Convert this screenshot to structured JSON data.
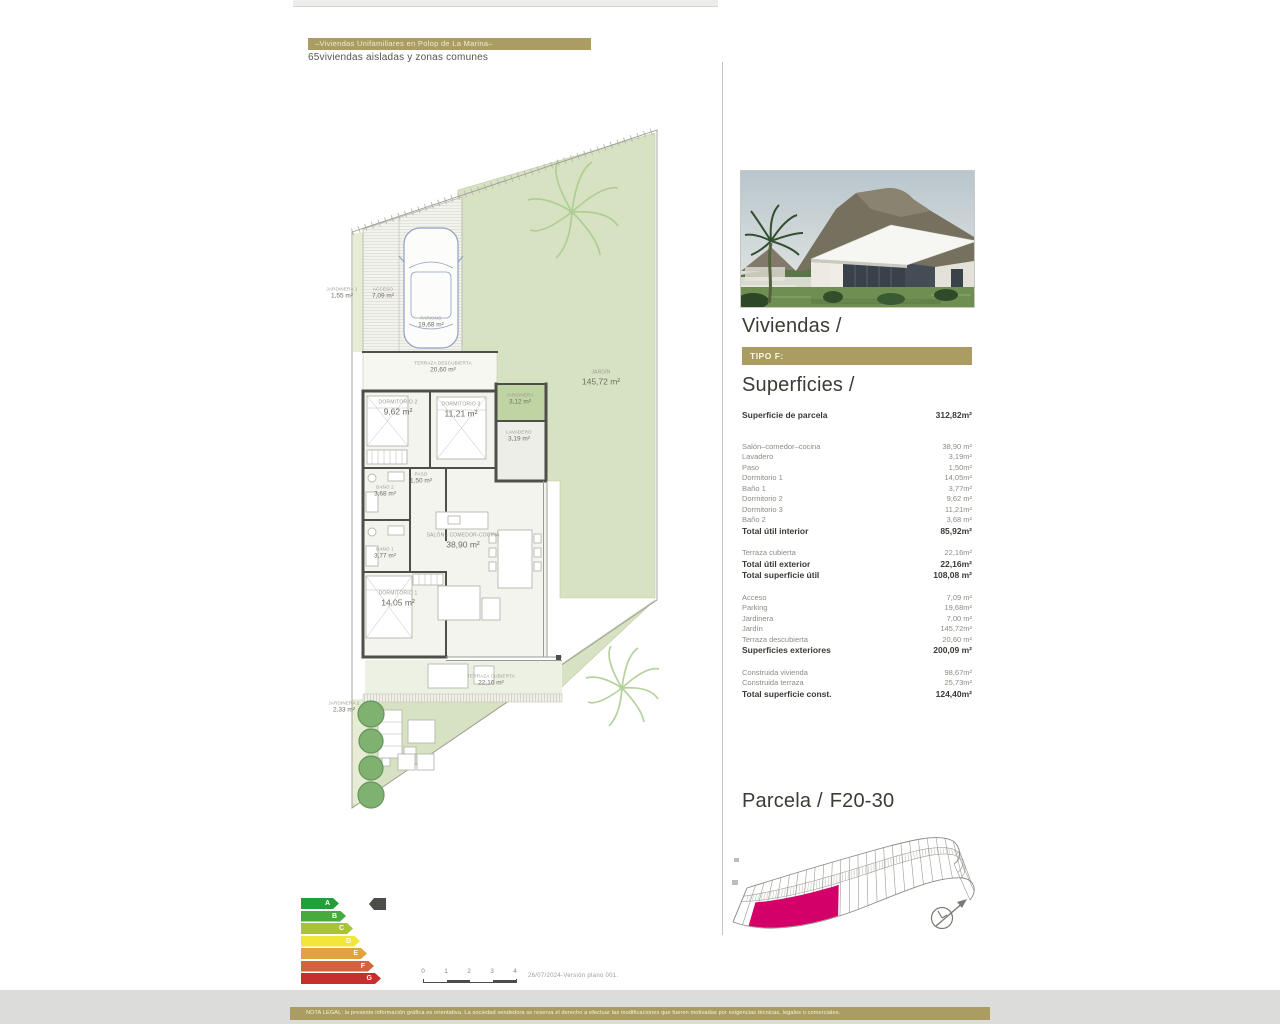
{
  "header": {
    "title": "–Viviendas Unifamiliares en Polop de La Marina–",
    "subtitle": "65viviendas aisladas y zonas comunes"
  },
  "right_panel": {
    "viviendas_title": "Viviendas /",
    "tipo_label": "TIPO F:",
    "superficies_title": "Superficies /",
    "parcela_title": "Parcela /",
    "parcela_code": "F20-30"
  },
  "superficies": {
    "sections": [
      {
        "rows": [
          {
            "label": "Superficie de parcela",
            "value": "312,82m²",
            "bold": true
          }
        ]
      },
      {
        "rows": [
          {
            "label": "Salón–comedor–cocina",
            "value": "38,90 m²"
          },
          {
            "label": "Lavadero",
            "value": "3,19m²"
          },
          {
            "label": "Paso",
            "value": "1,50m²"
          },
          {
            "label": "Dormitorio 1",
            "value": "14,05m²"
          },
          {
            "label": "Baño 1",
            "value": "3,77m²"
          },
          {
            "label": "Dormitorio 2",
            "value": "9,62 m²"
          },
          {
            "label": "Dormitorio 3",
            "value": "11,21m²"
          },
          {
            "label": "Baño 2",
            "value": "3,68 m²"
          },
          {
            "label": "Total útil  interior",
            "value": "85,92m²",
            "bold": true
          }
        ]
      },
      {
        "rows": [
          {
            "label": "Terraza cubierta",
            "value": "22,16m²"
          },
          {
            "label": "Total útil  exterior",
            "value": "22,16m²",
            "bold": true
          },
          {
            "label": "Total superficie útil",
            "value": "108,08 m²",
            "bold": true
          }
        ]
      },
      {
        "rows": [
          {
            "label": "Acceso",
            "value": "7,09 m²"
          },
          {
            "label": "Parking",
            "value": "19,68m²"
          },
          {
            "label": "Jardinera",
            "value": "7,00 m²"
          },
          {
            "label": "Jardín",
            "value": "145,72m²"
          },
          {
            "label": "Terraza descubierta",
            "value": "20,60 m²"
          },
          {
            "label": "Superficies exteriores",
            "value": "200,09 m²",
            "bold": true
          }
        ]
      },
      {
        "rows": [
          {
            "label": "Construida vivienda",
            "value": "98,67m²"
          },
          {
            "label": "Construida terraza",
            "value": "25,73m²"
          },
          {
            "label": "Total superficie const.",
            "value": "124,40m²",
            "bold": true
          }
        ]
      }
    ]
  },
  "floorplan": {
    "labels": [
      {
        "title": "JARDINERA 1",
        "area": "1,55 m²",
        "x": 342,
        "y": 293,
        "size": "xs"
      },
      {
        "title": "ACCESO",
        "area": "7,09 m²",
        "x": 383,
        "y": 293,
        "size": "xs"
      },
      {
        "title": "PARKING",
        "area": "19,68 m²",
        "x": 431,
        "y": 322,
        "size": "xs"
      },
      {
        "title": "TERRAZA DESCUBIERTA",
        "area": "20,60 m²",
        "x": 443,
        "y": 367,
        "size": "xs"
      },
      {
        "title": "JARDINERA",
        "area": "3,12 m²",
        "x": 520,
        "y": 399,
        "size": "xs"
      },
      {
        "title": "DORMITORIO 2",
        "area": "9,62 m²",
        "x": 398,
        "y": 408,
        "size": "s"
      },
      {
        "title": "DORMITORIO 3",
        "area": "11,21 m²",
        "x": 461,
        "y": 410,
        "size": "s"
      },
      {
        "title": "LAVADERO",
        "area": "3,19 m²",
        "x": 519,
        "y": 436,
        "size": "xs"
      },
      {
        "title": "PASO",
        "area": "1,50 m²",
        "x": 421,
        "y": 478,
        "size": "xs"
      },
      {
        "title": "BAÑO 2",
        "area": "3,68 m²",
        "x": 385,
        "y": 491,
        "size": "xs"
      },
      {
        "title": "SALÓN - COMEDOR-COCINA",
        "area": "38,90 m²",
        "x": 463,
        "y": 541,
        "size": "s"
      },
      {
        "title": "BAÑO 1",
        "area": "3,77 m²",
        "x": 385,
        "y": 553,
        "size": "xs"
      },
      {
        "title": "DORMITORIO 1",
        "area": "14,05 m²",
        "x": 398,
        "y": 599,
        "size": "s"
      },
      {
        "title": "TERRAZA CUBIERTA",
        "area": "22,16 m²",
        "x": 491,
        "y": 680,
        "size": "xs"
      },
      {
        "title": "JARDÍN",
        "area": "145,72 m²",
        "x": 601,
        "y": 378,
        "size": "s"
      },
      {
        "title": "JARDINERA 2",
        "area": "2,33 m²",
        "x": 344,
        "y": 707,
        "size": "xs"
      }
    ]
  },
  "energy": {
    "grades": [
      {
        "letter": "A",
        "color": "#21a038",
        "width": 38
      },
      {
        "letter": "B",
        "color": "#46ab3c",
        "width": 45
      },
      {
        "letter": "C",
        "color": "#a8c436",
        "width": 52
      },
      {
        "letter": "D",
        "color": "#f2e63a",
        "width": 59
      },
      {
        "letter": "E",
        "color": "#e0a33e",
        "width": 66
      },
      {
        "letter": "F",
        "color": "#d2633c",
        "width": 73
      },
      {
        "letter": "G",
        "color": "#c5302f",
        "width": 80
      }
    ]
  },
  "scalebar": {
    "ticks": [
      "0",
      "1",
      "2",
      "3",
      "4"
    ],
    "version": "26/07/2024-Versión  plano  001."
  },
  "legal": "NOTA LEGAL: la presente información gráfica es orientativa. La sociedad vendedora se reserva el derecho a efectuar las modificaciones que fueren motivadas por exigencias técnicas, legales o comerciales.",
  "colors": {
    "gold": "#ab9d62",
    "magenta": "#d4006a",
    "garden": "#d7e2c2"
  }
}
